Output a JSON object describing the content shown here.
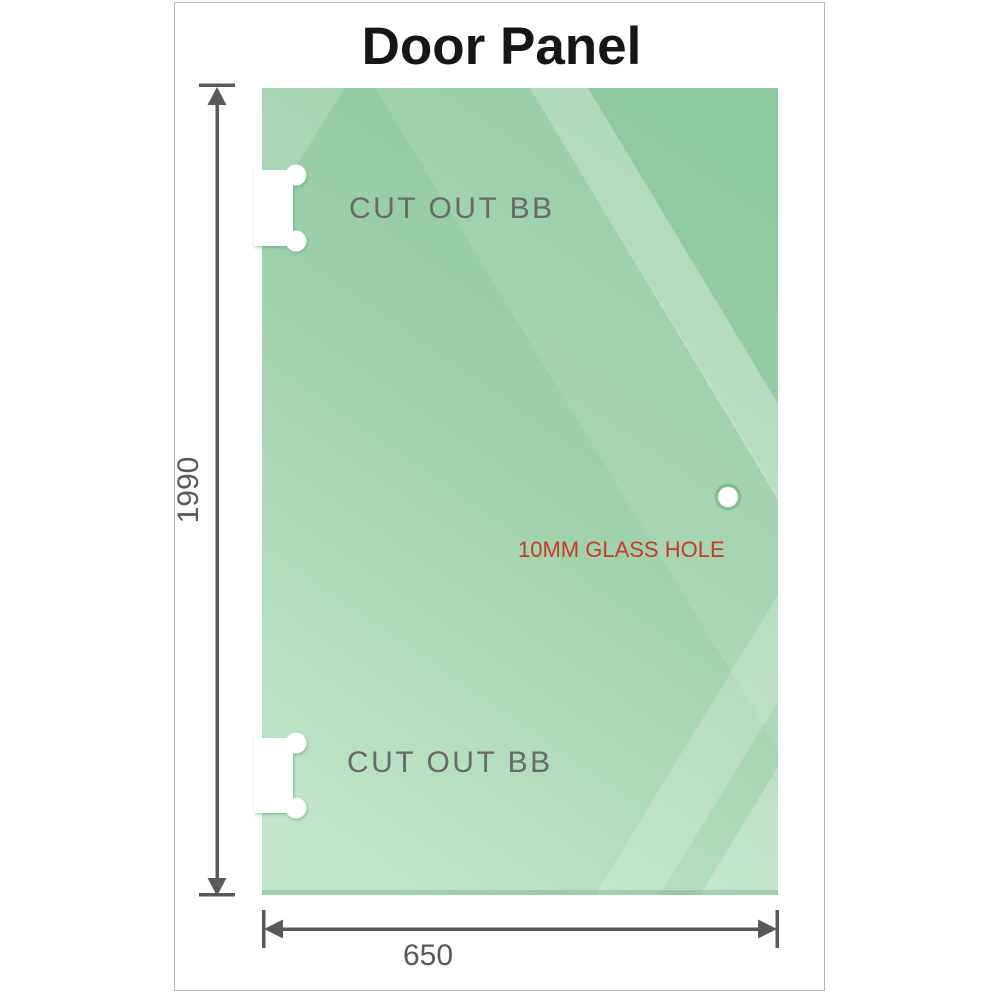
{
  "title": "Door Panel",
  "panel": {
    "name": "glass door panel",
    "cutout_top_label": "CUT OUT BB",
    "cutout_bottom_label": "CUT OUT BB",
    "hole_label": "10MM GLASS HOLE"
  },
  "dimensions": {
    "height_label": "1990",
    "width_label": "650"
  },
  "colors": {
    "glass_green_dark": "#8cc8a0",
    "glass_green_mid": "#a3d4b0",
    "glass_green_light": "#c2e5cb",
    "dimension_gray": "#58595b",
    "label_gray": "#67696a",
    "hole_label_red": "#c53a28",
    "frame_border": "#b7b7b7",
    "title_black": "#161616"
  }
}
